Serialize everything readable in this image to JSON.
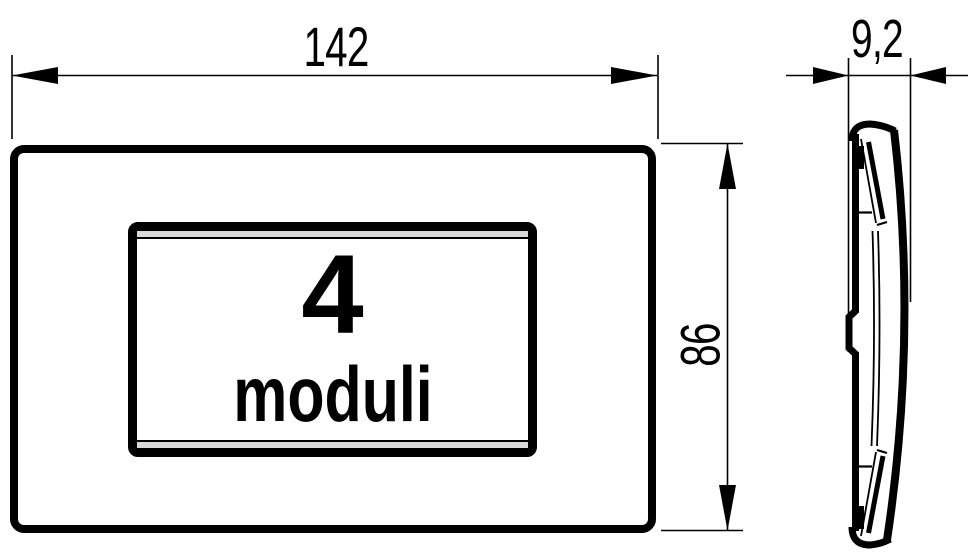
{
  "drawing": {
    "dimensions": {
      "width": "142",
      "height": "86",
      "depth": "9,2"
    },
    "front": {
      "module_count": "4",
      "module_label": "moduli"
    },
    "colors": {
      "line": "#000000",
      "bevel_gray": "#d9d9d9",
      "background": "#ffffff"
    }
  }
}
